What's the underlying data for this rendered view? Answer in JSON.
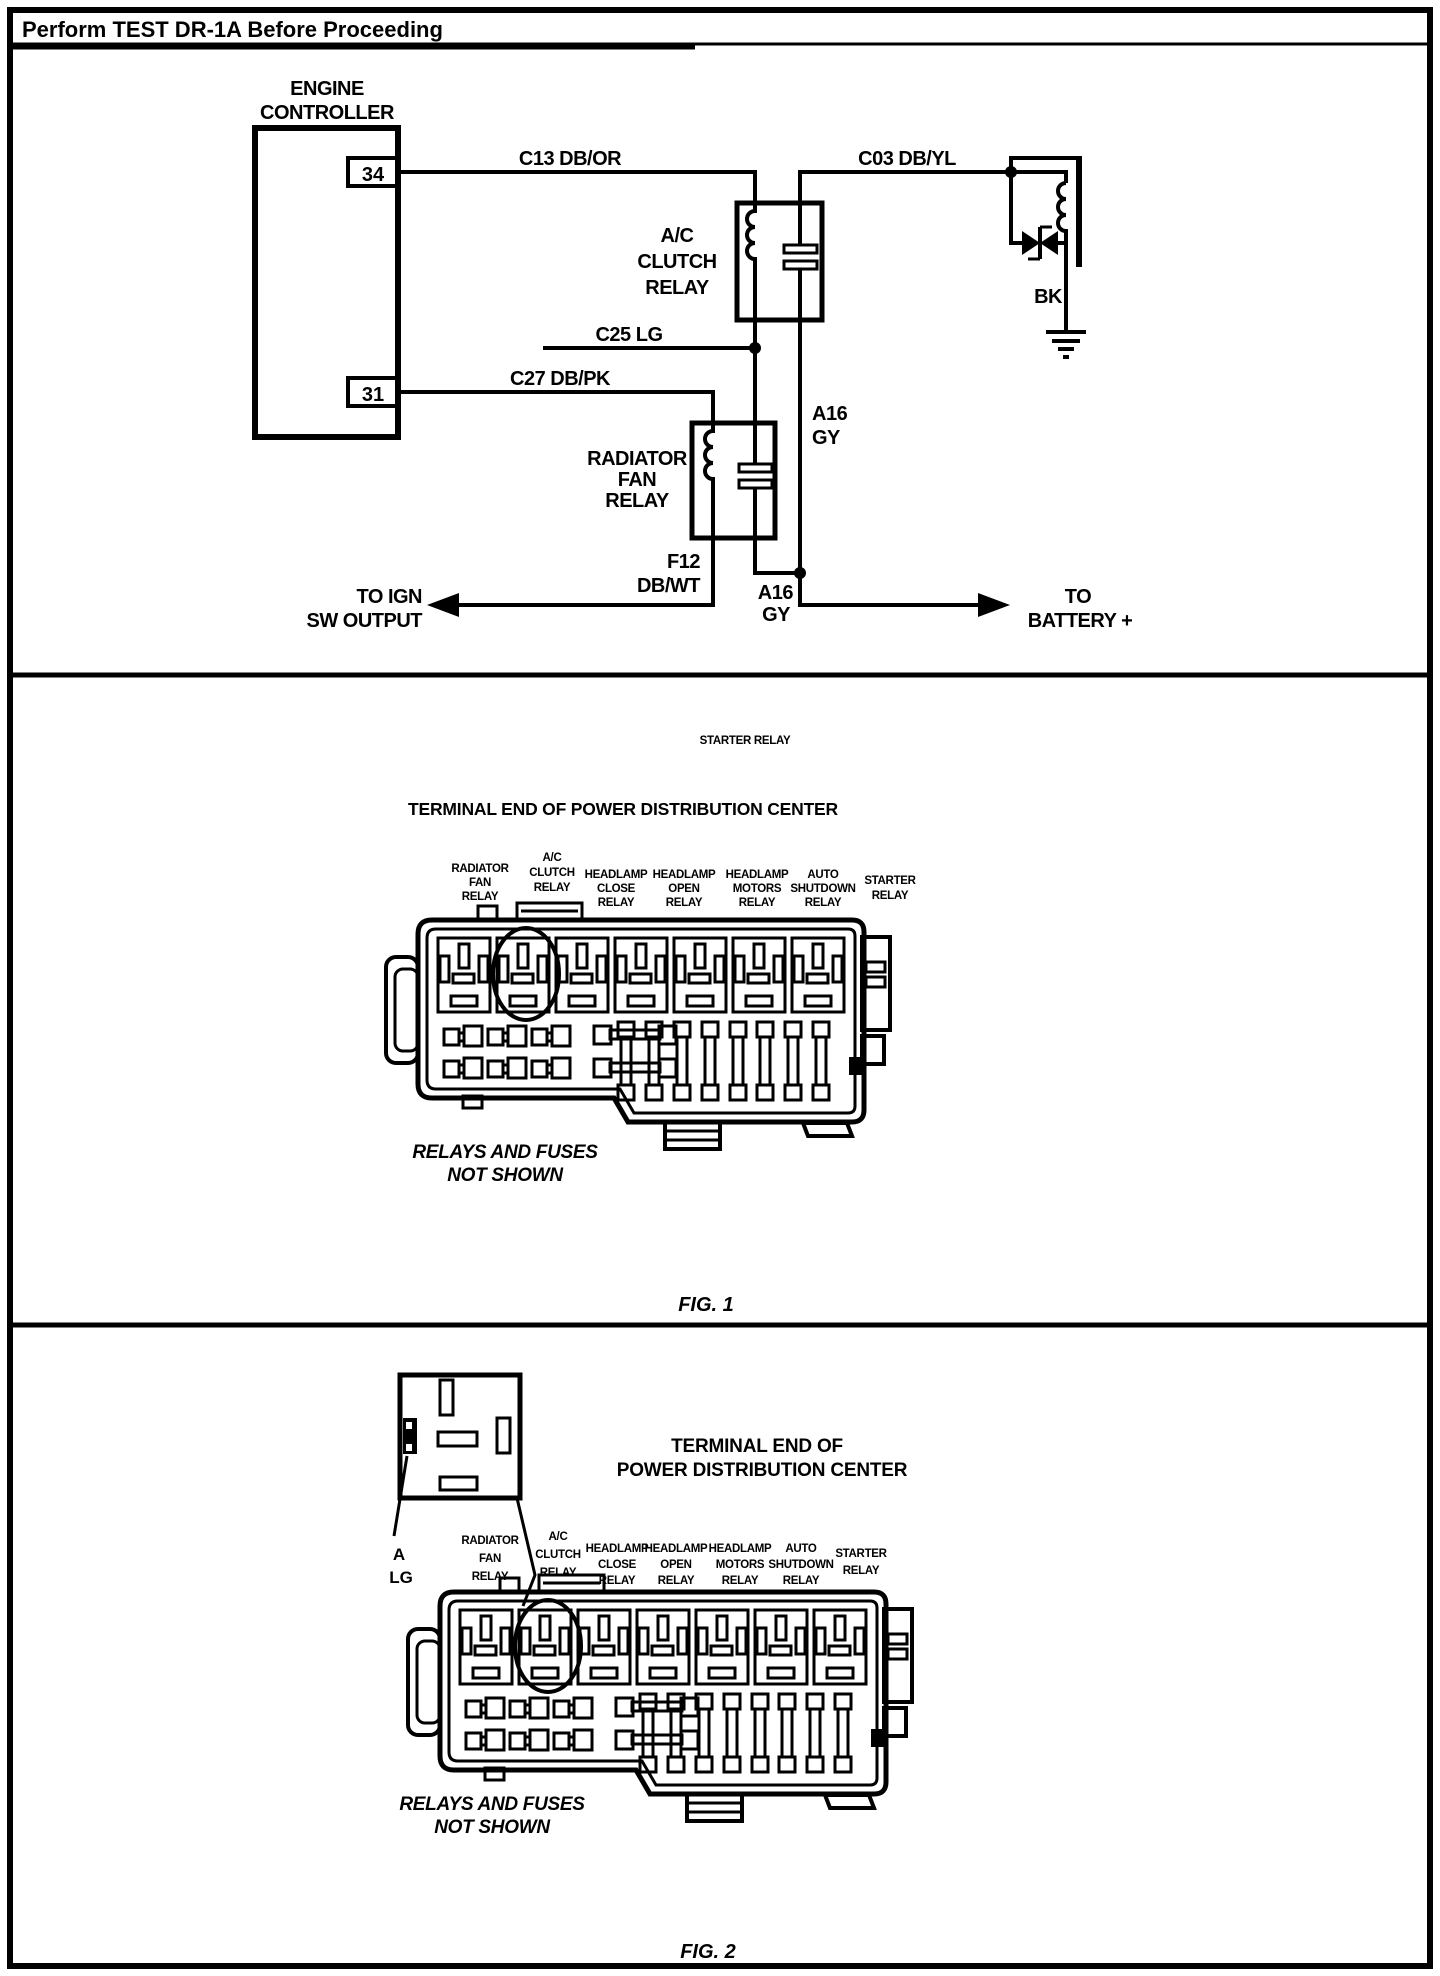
{
  "header": {
    "title": "Perform TEST DR-1A Before Proceeding"
  },
  "schematic": {
    "controller": {
      "lines": [
        "ENGINE",
        "CONTROLLER"
      ],
      "pin_top": "34",
      "pin_bottom": "31"
    },
    "wire_labels": {
      "c13": "C13 DB/OR",
      "c03": "C03 DB/YL",
      "c25": "C25 LG",
      "c27": "C27 DB/PK",
      "a16_upper": [
        "A16",
        "GY"
      ],
      "a16_lower": [
        "A16",
        "GY"
      ],
      "f12": [
        "F12",
        "DB/WT"
      ],
      "bk": "BK"
    },
    "ac_clutch_relay": [
      "A/C",
      "CLUTCH",
      "RELAY"
    ],
    "radiator_fan_relay": [
      "RADIATOR",
      "FAN",
      "RELAY"
    ],
    "to_ign": [
      "TO IGN",
      "SW OUTPUT"
    ],
    "to_battery": [
      "TO",
      "BATTERY +"
    ]
  },
  "fig1": {
    "floating_note": "STARTER RELAY",
    "title": "TERMINAL END OF POWER DISTRIBUTION CENTER",
    "relay_labels": [
      [
        "RADIATOR",
        "FAN",
        "RELAY"
      ],
      [
        "A/C",
        "CLUTCH",
        "RELAY"
      ],
      [
        "HEADLAMP",
        "CLOSE",
        "RELAY"
      ],
      [
        "HEADLAMP",
        "OPEN",
        "RELAY"
      ],
      [
        "HEADLAMP",
        "MOTORS",
        "RELAY"
      ],
      [
        "AUTO",
        "SHUTDOWN",
        "RELAY"
      ],
      [
        "STARTER",
        "RELAY"
      ]
    ],
    "not_shown": [
      "RELAYS AND FUSES",
      "NOT SHOWN"
    ],
    "caption": "FIG. 1"
  },
  "fig2": {
    "title_lines": [
      "TERMINAL END OF",
      "POWER DISTRIBUTION CENTER"
    ],
    "terminal_callout": [
      "A",
      "LG"
    ],
    "relay_labels": [
      [
        "RADIATOR",
        "FAN",
        "RELAY"
      ],
      [
        "A/C",
        "CLUTCH",
        "RELAY"
      ],
      [
        "HEADLAMP",
        "CLOSE",
        "RELAY"
      ],
      [
        "HEADLAMP",
        "OPEN",
        "RELAY"
      ],
      [
        "HEADLAMP",
        "MOTORS",
        "RELAY"
      ],
      [
        "AUTO",
        "SHUTDOWN",
        "RELAY"
      ],
      [
        "STARTER",
        "RELAY"
      ]
    ],
    "not_shown": [
      "RELAYS AND FUSES",
      "NOT SHOWN"
    ],
    "caption": "FIG. 2"
  }
}
